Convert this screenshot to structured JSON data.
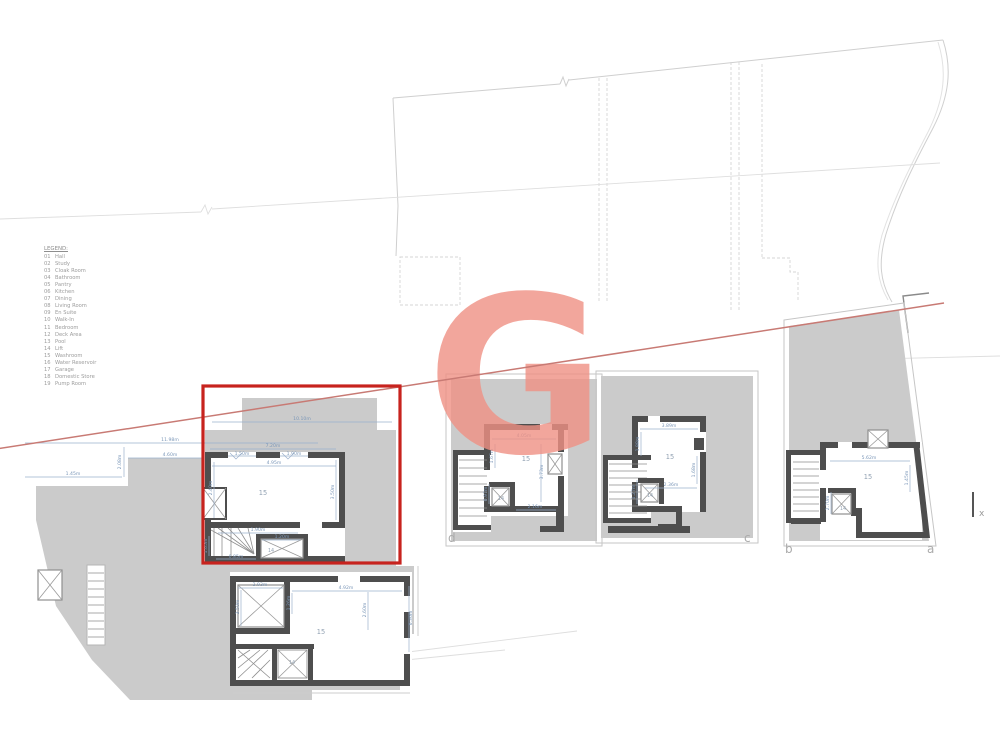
{
  "legend": {
    "title": "LEGEND:",
    "items": [
      {
        "num": "01",
        "label": "Hall"
      },
      {
        "num": "02",
        "label": "Study"
      },
      {
        "num": "03",
        "label": "Cloak Room"
      },
      {
        "num": "04",
        "label": "Bathroom"
      },
      {
        "num": "05",
        "label": "Pantry"
      },
      {
        "num": "06",
        "label": "Kitchen"
      },
      {
        "num": "07",
        "label": "Dining"
      },
      {
        "num": "08",
        "label": "Living Room"
      },
      {
        "num": "09",
        "label": "En Suite"
      },
      {
        "num": "10",
        "label": "Walk-In"
      },
      {
        "num": "11",
        "label": "Bedroom"
      },
      {
        "num": "12",
        "label": "Deck Area"
      },
      {
        "num": "13",
        "label": "Pool"
      },
      {
        "num": "14",
        "label": "Lift"
      },
      {
        "num": "15",
        "label": "Washroom"
      },
      {
        "num": "16",
        "label": "Water Reservoir"
      },
      {
        "num": "17",
        "label": "Garage"
      },
      {
        "num": "18",
        "label": "Domestic Store"
      },
      {
        "num": "19",
        "label": "Pump Room"
      }
    ]
  },
  "watermark": {
    "letter": "G",
    "color": "#f09184"
  },
  "rooms": {
    "washroom": "15",
    "lift": "14"
  },
  "markers": {
    "unit_a": "a",
    "unit_b": "b",
    "unit_c": "c",
    "unit_d": "d",
    "boundary_x": "x"
  },
  "colors": {
    "highlight_red": "#c7231e",
    "section_line": "#c87a74",
    "wall": "#4e4e4e",
    "terrace_gray": "#cbcbcb",
    "dim_blue": "#7b97b8"
  },
  "dims": {
    "terrace": {
      "width_total": "11.98m",
      "width_upper": "4.60m",
      "width_left": "1.45m",
      "depth_left": "2.08m",
      "width_main": "10.10m"
    },
    "unit_highlight": {
      "top": "7.20m",
      "door_left": "1.50m",
      "door_right": "1.90m",
      "room_width": "4.95m",
      "room_height": "3.50m",
      "room_left": "2.40m",
      "stair_width": "1.90m",
      "lift_width": "1.20m",
      "stair_bottom": "0.85m",
      "stair_left": "1.05m"
    },
    "unit_lower": {
      "skylight_width": "2.93m",
      "skylight_height": "2.50m",
      "room_width": "4.92m",
      "left_height": "1.26m",
      "right_height": "2.60m",
      "outer_height": "6.36m"
    },
    "unit_d": {
      "room_width": "4.05m",
      "left_height": "1.67m",
      "right_height": "3.73m",
      "bottom_width": "2.16m",
      "lift_height": "0.97m"
    },
    "unit_c": {
      "room_width": "3.89m",
      "left_height": "1.88m",
      "right_height": "1.68m",
      "bottom_width": "2.36m",
      "lift_height": "1.27m"
    },
    "unit_b": {
      "room_width": "5.62m",
      "right_height": "1.45m",
      "lift_height": "2.70m"
    }
  }
}
